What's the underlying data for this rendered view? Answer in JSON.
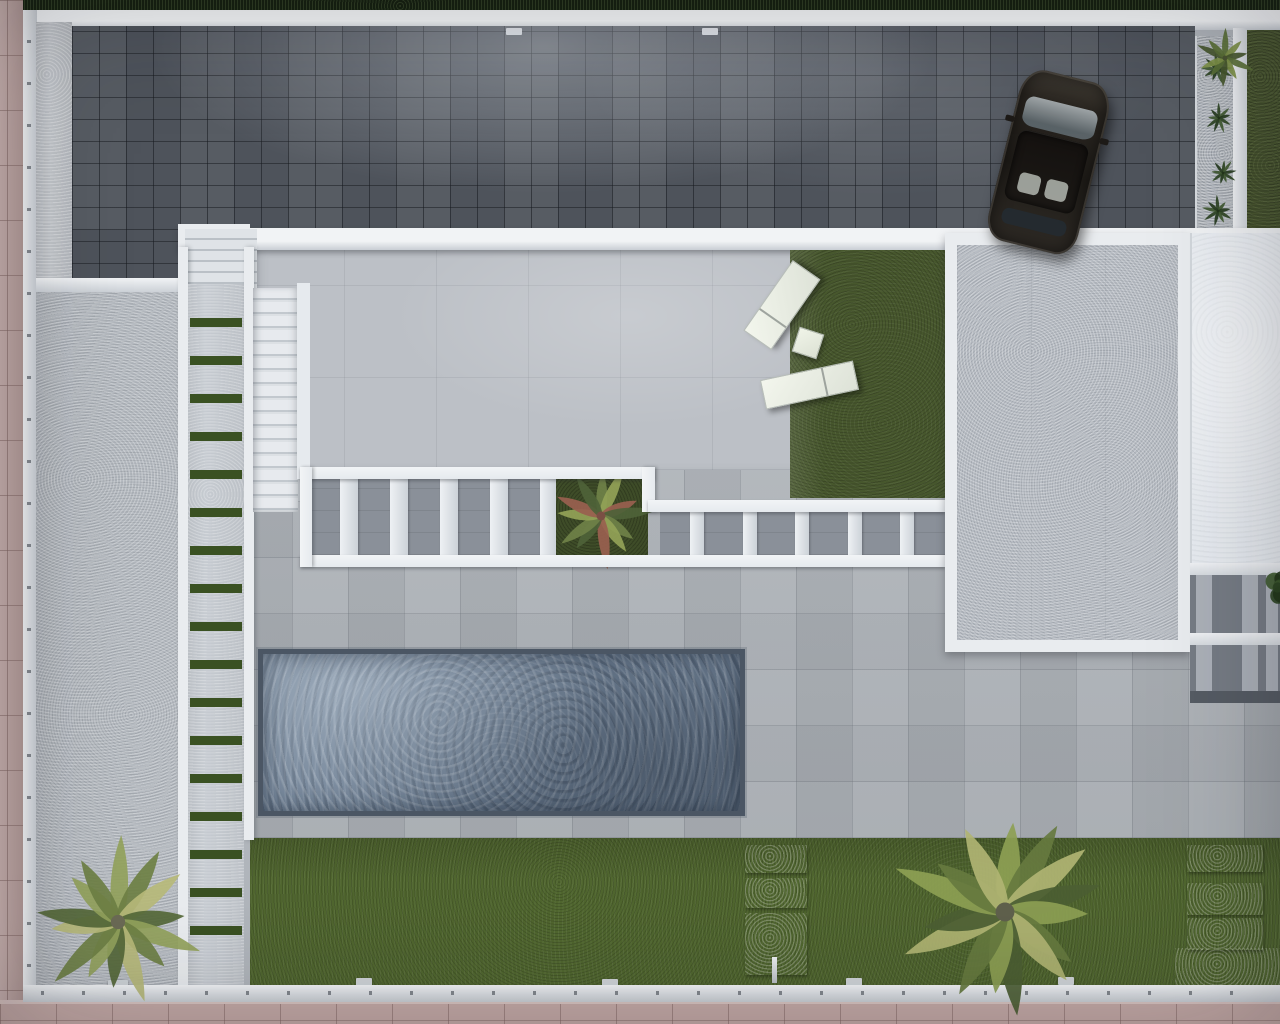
{
  "meta": {
    "title": "Aerial top-down 3D architectural render of a villa plot with driveway, terrace, pergola, pool and garden",
    "type": "architectural-render",
    "visible_text": "none"
  },
  "palette": {
    "pink_paving": "#c5aaa7",
    "pink_paving_light": "#d9c4c1",
    "wall_white": "#e9ecef",
    "wall_shadow": "#c9ced4",
    "post_gray": "#84898f",
    "hedge_dark": "#15200f",
    "hedge_right": "#48552f",
    "paver_dark": "#4e535b",
    "concrete_light": "#c2c6cb",
    "side_pad": "#b6bbc1",
    "walkway": "#c6cbd1",
    "walkway_stripe": "#3a5122",
    "terrace": "#b0b5bb",
    "upper_terrace": "#bcc0c6",
    "grass_dark": "#47572d",
    "lawn": "#50662f",
    "pool_rim": "#4b5664",
    "pool_water": "#6e7f93",
    "pergola_white": "#e6eaee",
    "pergola_gap": "#8a9099",
    "pad_inner": "#b7bcc3",
    "white_pad": "#e8ecf1",
    "right_pergola_bg": "#767c85",
    "right_pergola_slat": "#b6bbc2",
    "car_body": "#1f1c18",
    "lounger_white": "#eef2e9",
    "stone_light": "#c4c9ce"
  },
  "scene": {
    "driveway": {
      "label": "dark block-paved driveway",
      "car_angle_deg": 14
    },
    "walkway": {
      "label": "side path with grass joints",
      "stripe_count": 17
    },
    "stairs": {
      "label": "exterior staircase",
      "tread_count": 16
    },
    "entry_steps": {
      "label": "entry steps from driveway",
      "tread_count": 5
    },
    "pergola": {
      "label": "flat pergola beams over lower terrace",
      "left_slat_count": 5,
      "right_slat_count": 5
    },
    "pool": {
      "label": "rectangular swimming pool"
    },
    "lawn": {
      "label": "rear lawn",
      "stepping_stones_center": 3,
      "stepping_stones_right": 3
    },
    "loungers": [
      {
        "label": "sun lounger upper",
        "angle_deg": -55
      },
      {
        "label": "sun lounger lower",
        "angle_deg": -12
      }
    ],
    "side_table_angle_deg": 18,
    "plants": [
      {
        "target": "palm-1",
        "type": "frond",
        "size": 178,
        "fronds": 14,
        "seed": 3,
        "trunk": "#6b6a55",
        "colors": [
          "#93a25c",
          "#6e8044",
          "#b7ba79",
          "#556838"
        ]
      },
      {
        "target": "palm-2",
        "type": "frond",
        "size": 236,
        "fronds": 15,
        "seed": 8,
        "trunk": "#5f604c",
        "colors": [
          "#8da054",
          "#66793f",
          "#b0b473",
          "#4c5e33"
        ]
      },
      {
        "target": "corner-plant",
        "type": "frond",
        "size": 64,
        "fronds": 10,
        "seed": 5,
        "trunk": "#4a5432",
        "colors": [
          "#5a7036",
          "#7e9147",
          "#46572c"
        ]
      },
      {
        "target": "shrub-1",
        "type": "frond",
        "size": 34,
        "fronds": 9,
        "seed": 21,
        "trunk": "#23351b",
        "colors": [
          "#2e4423",
          "#3f5830",
          "#253a1d"
        ]
      },
      {
        "target": "shrub-2",
        "type": "frond",
        "size": 32,
        "fronds": 9,
        "seed": 22,
        "trunk": "#23351b",
        "colors": [
          "#2e4423",
          "#3f5830",
          "#253a1d"
        ]
      },
      {
        "target": "shrub-3",
        "type": "frond",
        "size": 30,
        "fronds": 9,
        "seed": 23,
        "trunk": "#23351b",
        "colors": [
          "#2e4423",
          "#3f5830",
          "#253a1d"
        ]
      },
      {
        "target": "shrub-4",
        "type": "frond",
        "size": 34,
        "fronds": 9,
        "seed": 24,
        "trunk": "#23351b",
        "colors": [
          "#2e4423",
          "#3f5830",
          "#253a1d"
        ]
      },
      {
        "target": "planter-plant",
        "type": "frond",
        "size": 112,
        "fronds": 12,
        "seed": 11,
        "trunk": "#7a4f44",
        "colors": [
          "#6f8148",
          "#92a257",
          "#99604f",
          "#4e6238"
        ]
      },
      {
        "target": "pergola-bush",
        "type": "bush",
        "size": 42,
        "seed": 4,
        "colors": [
          "#2c4522",
          "#3d5a2e",
          "#223619"
        ]
      }
    ]
  }
}
